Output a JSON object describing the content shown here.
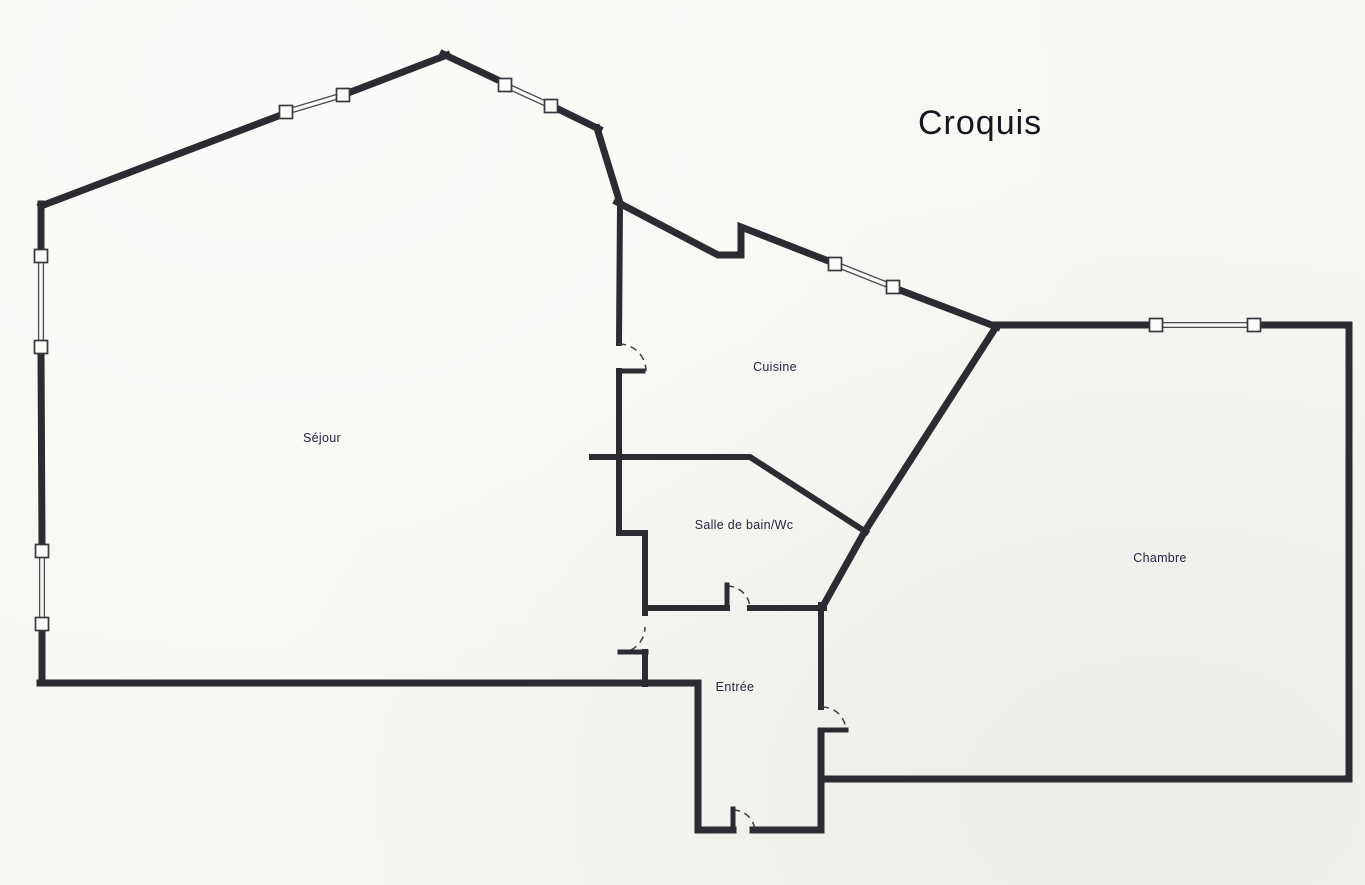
{
  "title": "Croquis",
  "colors": {
    "wall": "#2b2b31",
    "paper": "#f6f6f2",
    "label": "#262640",
    "thin_line": "#4a4a52",
    "window_fill": "#fbfbf8",
    "arc": "#3f3f48"
  },
  "rooms": [
    {
      "id": "sejour",
      "label": "Séjour",
      "x": 322,
      "y": 438
    },
    {
      "id": "cuisine",
      "label": "Cuisine",
      "x": 775,
      "y": 367
    },
    {
      "id": "salle-de-bain-wc",
      "label": "Salle de bain/Wc",
      "x": 744,
      "y": 525
    },
    {
      "id": "entree",
      "label": "Entrée",
      "x": 735,
      "y": 687
    },
    {
      "id": "chambre",
      "label": "Chambre",
      "x": 1160,
      "y": 558
    }
  ],
  "walls": [
    {
      "id": "wall-left-a",
      "w": 7,
      "points": [
        [
          41,
          204
        ],
        [
          41,
          251
        ]
      ]
    },
    {
      "id": "wall-left-b",
      "w": 7,
      "points": [
        [
          41,
          352
        ],
        [
          42,
          546
        ]
      ]
    },
    {
      "id": "wall-left-c",
      "w": 7,
      "points": [
        [
          42,
          629
        ],
        [
          42,
          683
        ]
      ]
    },
    {
      "id": "wall-topleft-diag-a",
      "w": 7,
      "points": [
        [
          41,
          206
        ],
        [
          281,
          115
        ]
      ]
    },
    {
      "id": "wall-topleft-diag-b",
      "w": 7,
      "points": [
        [
          348,
          93
        ],
        [
          447,
          55
        ]
      ]
    },
    {
      "id": "wall-topright-diag-a",
      "w": 7,
      "points": [
        [
          443,
          54
        ],
        [
          500,
          81
        ]
      ]
    },
    {
      "id": "wall-topright-diag-b",
      "w": 7,
      "points": [
        [
          556,
          108
        ],
        [
          599,
          129
        ]
      ]
    },
    {
      "id": "wall-step",
      "w": 7,
      "points": [
        [
          597,
          128
        ],
        [
          620,
          203
        ]
      ]
    },
    {
      "id": "wall-cuisine-north-a",
      "w": 7,
      "points": [
        [
          617,
          202
        ],
        [
          718,
          255
        ],
        [
          741,
          255
        ],
        [
          741,
          227
        ],
        [
          831,
          262
        ]
      ]
    },
    {
      "id": "wall-cuisine-north-b",
      "w": 7,
      "points": [
        [
          897,
          289
        ],
        [
          997,
          327
        ]
      ]
    },
    {
      "id": "wall-chambre-north-a",
      "w": 7,
      "points": [
        [
          994,
          325
        ],
        [
          1151,
          325
        ]
      ]
    },
    {
      "id": "wall-chambre-outline",
      "w": 7,
      "points": [
        [
          1259,
          325
        ],
        [
          1349,
          325
        ],
        [
          1349,
          779
        ],
        [
          822,
          779
        ]
      ]
    },
    {
      "id": "wall-chambre-west-diag",
      "w": 7,
      "points": [
        [
          996,
          327
        ],
        [
          865,
          531
        ],
        [
          823,
          606
        ]
      ]
    },
    {
      "id": "wall-sejour-cuisine-a",
      "w": 6,
      "points": [
        [
          620,
          204
        ],
        [
          619,
          343
        ]
      ]
    },
    {
      "id": "wall-sejour-cuisine-b",
      "w": 6,
      "points": [
        [
          619,
          371
        ],
        [
          619,
          533
        ],
        [
          645,
          533
        ],
        [
          645,
          613
        ]
      ]
    },
    {
      "id": "wall-sejour-entree-stub",
      "w": 6,
      "points": [
        [
          645,
          652
        ],
        [
          645,
          684
        ]
      ]
    },
    {
      "id": "wall-sejour-south",
      "w": 7,
      "points": [
        [
          40,
          683
        ],
        [
          698,
          683
        ],
        [
          698,
          830
        ],
        [
          733,
          830
        ]
      ]
    },
    {
      "id": "wall-entree-south-east",
      "w": 7,
      "points": [
        [
          753,
          830
        ],
        [
          821,
          830
        ],
        [
          821,
          731
        ]
      ]
    },
    {
      "id": "wall-entree-chambre",
      "w": 6,
      "points": [
        [
          821,
          707
        ],
        [
          821,
          605
        ]
      ]
    },
    {
      "id": "wall-sdb-north",
      "w": 6,
      "points": [
        [
          592,
          457
        ],
        [
          750,
          457
        ],
        [
          866,
          532
        ]
      ]
    },
    {
      "id": "wall-sdb-south-a",
      "w": 6,
      "points": [
        [
          645,
          608
        ],
        [
          727,
          608
        ]
      ]
    },
    {
      "id": "wall-sdb-south-b",
      "w": 6,
      "points": [
        [
          750,
          608
        ],
        [
          824,
          608
        ]
      ]
    }
  ],
  "windows": [
    {
      "id": "window-left-upper",
      "x1": 41,
      "y1": 256,
      "x2": 41,
      "y2": 347
    },
    {
      "id": "window-left-lower",
      "x1": 42,
      "y1": 551,
      "x2": 42,
      "y2": 624
    },
    {
      "id": "window-topleft-diag",
      "x1": 286,
      "y1": 112,
      "x2": 343,
      "y2": 95
    },
    {
      "id": "window-topright-diag",
      "x1": 505,
      "y1": 85,
      "x2": 551,
      "y2": 106
    },
    {
      "id": "window-cuisine",
      "x1": 835,
      "y1": 264,
      "x2": 893,
      "y2": 287
    },
    {
      "id": "window-chambre",
      "x1": 1156,
      "y1": 325,
      "x2": 1254,
      "y2": 325
    }
  ],
  "doors": [
    {
      "id": "door-sejour-cuisine",
      "arc": "M 619 344 A 27 27 0 0 1 646 371",
      "leaf": [
        619,
        371,
        643,
        371
      ]
    },
    {
      "id": "door-salle-de-bain",
      "arc": "M 727 586 A 23 23 0 0 1 750 609",
      "leaf": [
        727,
        608,
        727,
        585
      ]
    },
    {
      "id": "door-sejour-entree",
      "arc": "M 619 653 A 26 26 0 0 0 645 627",
      "leaf": [
        646,
        652,
        620,
        652
      ]
    },
    {
      "id": "door-entree-chambre",
      "arc": "M 822 707 A 24 24 0 0 1 846 731",
      "leaf": [
        821,
        730,
        846,
        730
      ]
    },
    {
      "id": "door-entree-south",
      "arc": "M 733 810 A 22 22 0 0 1 755 832",
      "leaf": [
        733,
        831,
        733,
        809
      ]
    }
  ]
}
